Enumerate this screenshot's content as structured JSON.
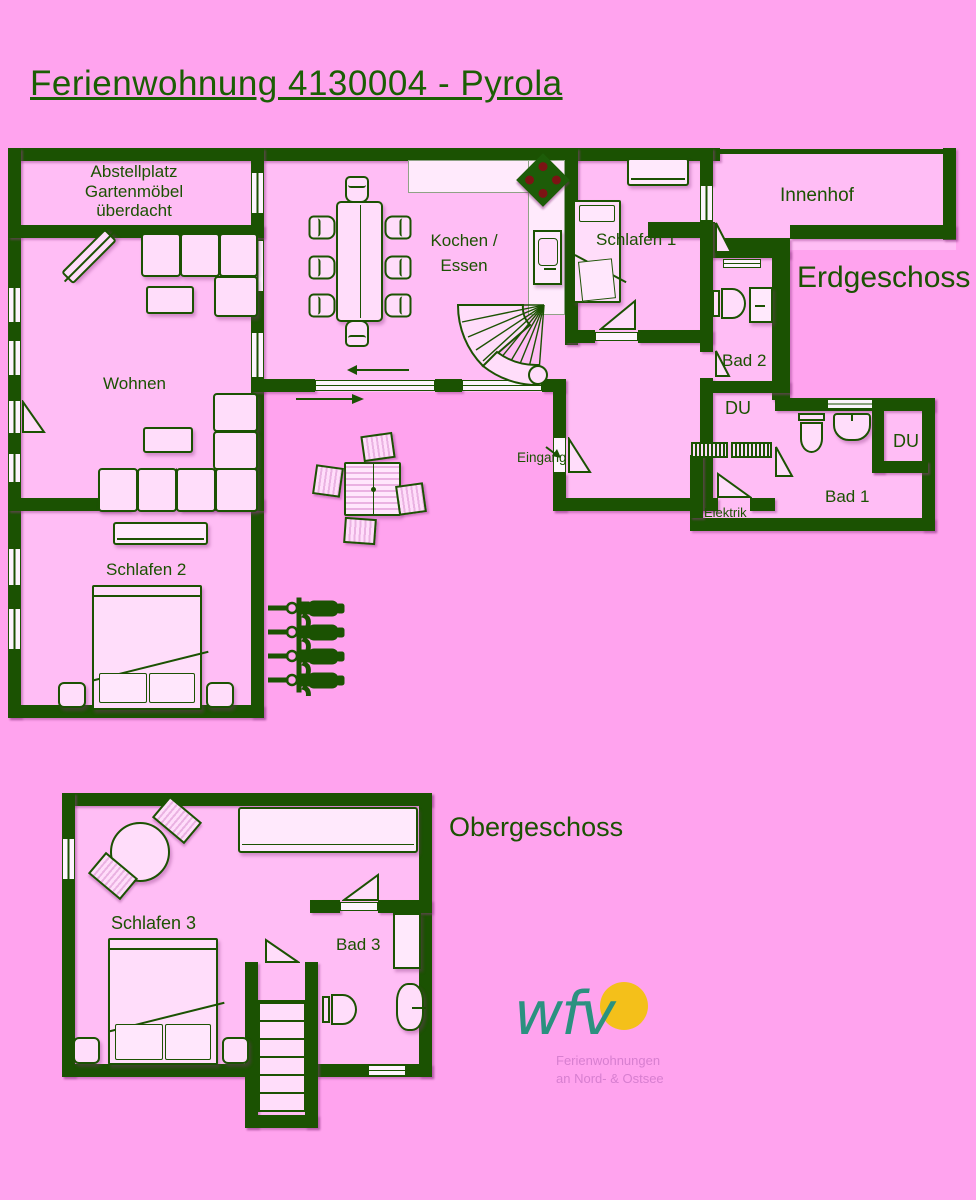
{
  "title": "Ferienwohnung 4130004 - Pyrola",
  "ground": {
    "floor_label": "Erdgeschoss",
    "abstellplatz": "Abstellplatz\nGartenmöbel\nüberdacht",
    "wohnen": "Wohnen",
    "kochen_essen": "Kochen /\nEssen",
    "schlafen1": "Schlafen 1",
    "innenhof": "Innenhof",
    "bad2": "Bad 2",
    "du_mitte": "DU",
    "eingang": "Eingang",
    "elektrik": "Elektrik",
    "bad1": "Bad 1",
    "du_bad1": "DU",
    "schlafen2": "Schlafen 2"
  },
  "upper": {
    "floor_label": "Obergeschoss",
    "schlafen3": "Schlafen 3",
    "bad3": "Bad 3"
  },
  "logo": {
    "text": "wfv",
    "tagline": "Ferienwohnungen\nan Nord- & Ostsee"
  },
  "colors": {
    "background": "#ffa3ee",
    "room_fill": "#ffbdf5",
    "wall_green": "#1b5202",
    "sun_yellow": "#f4c01a",
    "logo_teal": "#2b9180",
    "tagline_pink": "#d77fd0",
    "burner_red": "#7c1414"
  }
}
